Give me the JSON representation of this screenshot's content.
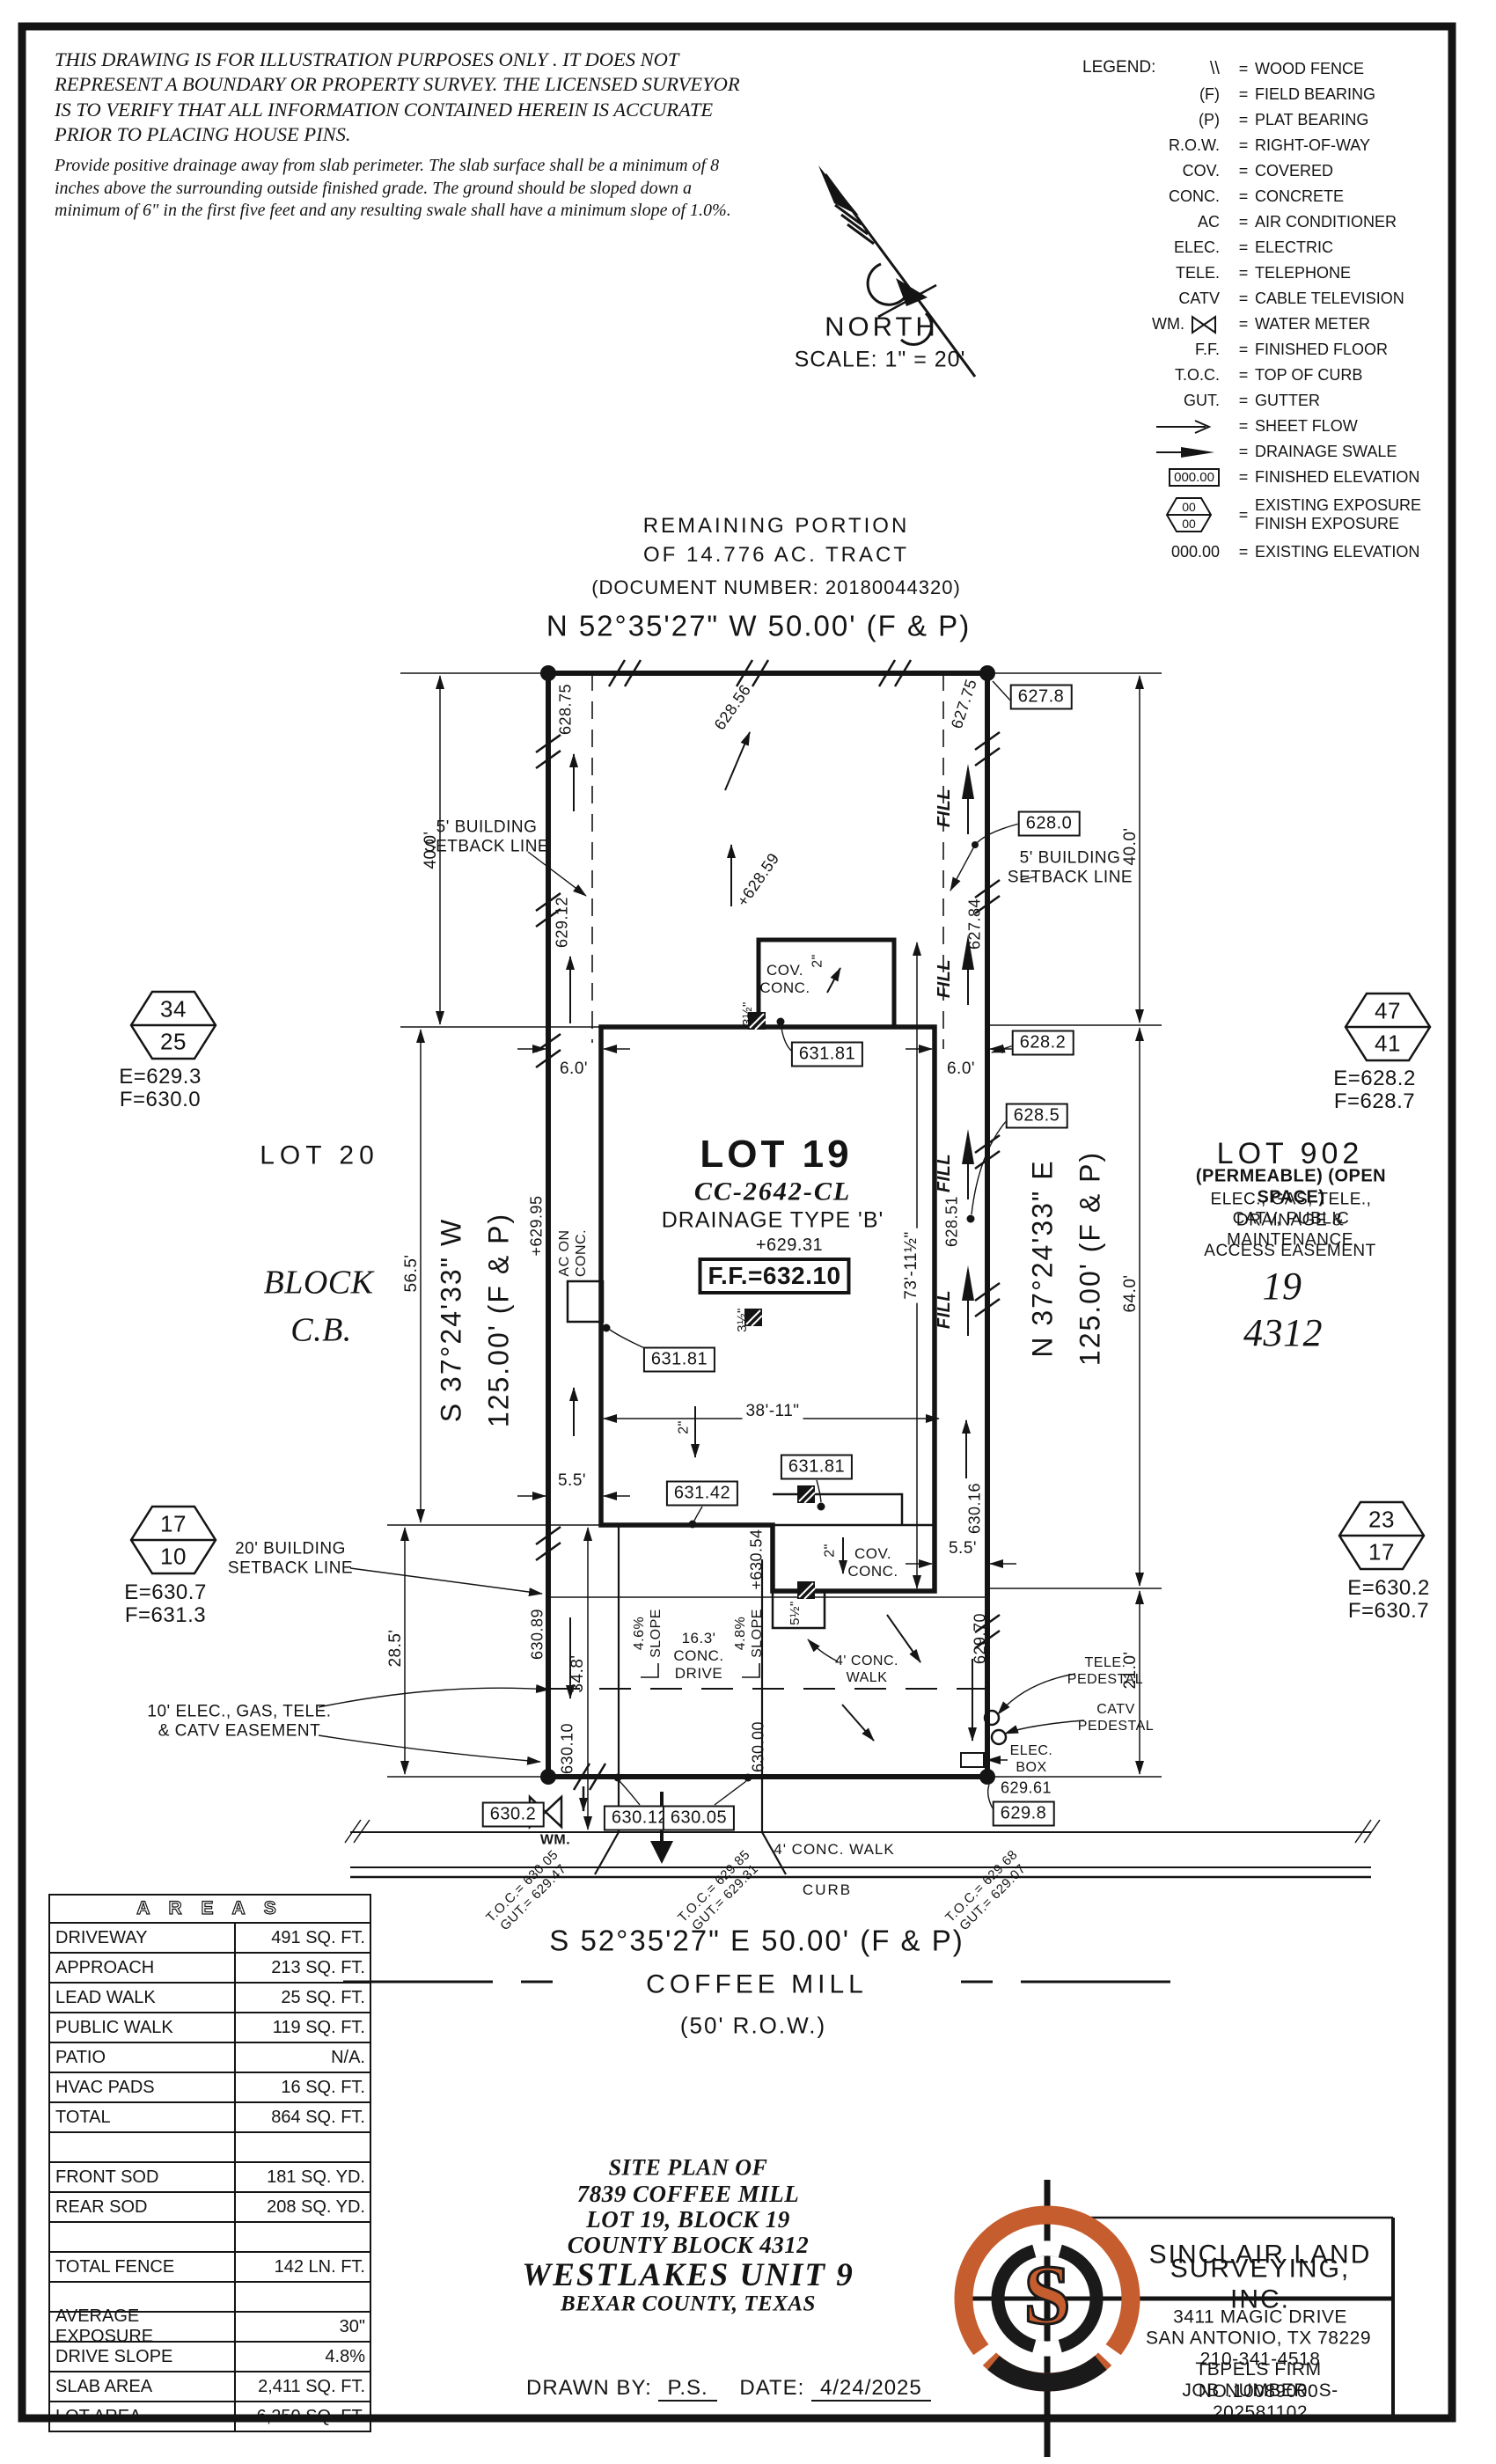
{
  "disclaimer": {
    "para1": "THIS DRAWING IS FOR ILLUSTRATION PURPOSES ONLY . IT DOES\nNOT REPRESENT A BOUNDARY OR PROPERTY SURVEY. THE\nLICENSED SURVEYOR IS TO VERIFY THAT ALL INFORMATION\nCONTAINED HEREIN IS ACCURATE PRIOR TO PLACING HOUSE PINS.",
    "para2": "Provide positive drainage away from slab perimeter. The slab surface shall be a\nminimum of 8 inches above the surrounding outside finished grade. The ground should be\nsloped down a minimum of 6\" in the first five feet and any resulting swale shall have a\nminimum slope of 1.0%."
  },
  "north": {
    "label": "NORTH",
    "scale": "SCALE: 1\" = 20'"
  },
  "legend": {
    "title": "LEGEND:",
    "eq": "=",
    "hex00": "00",
    "rows": [
      {
        "sym": "\\\\",
        "desc": "WOOD FENCE"
      },
      {
        "sym": "(F)",
        "desc": "FIELD BEARING"
      },
      {
        "sym": "(P)",
        "desc": "PLAT BEARING"
      },
      {
        "sym": "R.O.W.",
        "desc": "RIGHT-OF-WAY"
      },
      {
        "sym": "COV.",
        "desc": "COVERED"
      },
      {
        "sym": "CONC.",
        "desc": "CONCRETE"
      },
      {
        "sym": "AC",
        "desc": "AIR CONDITIONER"
      },
      {
        "sym": "ELEC.",
        "desc": "ELECTRIC"
      },
      {
        "sym": "TELE.",
        "desc": "TELEPHONE"
      },
      {
        "sym": "CATV",
        "desc": "CABLE TELEVISION"
      },
      {
        "sym": "WM.",
        "desc": "WATER METER"
      },
      {
        "sym": "F.F.",
        "desc": "FINISHED FLOOR"
      },
      {
        "sym": "T.O.C.",
        "desc": "TOP OF CURB"
      },
      {
        "sym": "GUT.",
        "desc": "GUTTER"
      },
      {
        "sym": "",
        "desc": "SHEET FLOW"
      },
      {
        "sym": "",
        "desc": "DRAINAGE SWALE"
      },
      {
        "sym": "000.00",
        "desc": "FINISHED ELEVATION"
      },
      {
        "sym": "",
        "desc": "EXISTING EXPOSURE\nFINISH EXPOSURE"
      },
      {
        "sym": "000.00",
        "desc": "EXISTING ELEVATION"
      }
    ]
  },
  "tract": {
    "line1": "REMAINING PORTION",
    "line2": "OF 14.776 AC. TRACT",
    "doc": "(DOCUMENT NUMBER: 20180044320)"
  },
  "bearings": {
    "top": "N 52°35'27\" W  50.00' (F & P)",
    "bottom": "S 52°35'27\" E  50.00' (F & P)",
    "left": "S 37°24'33\" W\n125.00' (F & P)",
    "right": "N 37°24'33\" E\n125.00' (F & P)"
  },
  "street": {
    "name": "COFFEE MILL",
    "row": "(50' R.O.W.)",
    "curb": "CURB",
    "walk": "4' CONC. WALK"
  },
  "lot": {
    "title": "LOT 19",
    "plan": "CC-2642-CL",
    "drainage": "DRAINAGE TYPE 'B'",
    "spot": "+629.31",
    "ff": "F.F.=632.10"
  },
  "neighbors": {
    "lot20": "LOT 20",
    "block": "BLOCK",
    "cb": "C.B.",
    "lot902": "LOT 902",
    "permeable": "(PERMEABLE) (OPEN SPACE)",
    "ease1": "ELEC., GAS, TELE., CATV, PUBLIC",
    "ease2": "DRAINAGE & MAINTENANCE",
    "ease3": "ACCESS EASEMENT",
    "blk19": "19",
    "cb4312": "4312"
  },
  "hex": {
    "h1t": "34",
    "h1b": "25",
    "h1e": "E=629.3",
    "h1f": "F=630.0",
    "h2t": "47",
    "h2b": "41",
    "h2e": "E=628.2",
    "h2f": "F=628.7",
    "h3t": "17",
    "h3b": "10",
    "h3e": "E=630.7",
    "h3f": "F=631.3",
    "h4t": "23",
    "h4b": "17",
    "h4e": "E=630.2",
    "h4f": "F=630.7"
  },
  "callouts": {
    "setback5": "5' BUILDING\nSETBACK LINE",
    "setback20": "20' BUILDING\nSETBACK LINE",
    "easement10": "10' ELEC., GAS, TELE.\n& CATV EASEMENT",
    "covconc": "COV.\nCONC.",
    "ac": "AC ON\nCONC.",
    "drive": "16.3'\nCONC.\nDRIVE",
    "slope46": "4.6%\nSLOPE",
    "slope48": "4.8%\nSLOPE",
    "leadwalk": "4' CONC.\nWALK",
    "tele": "TELE.\nPEDESTAL",
    "catv": "CATV\nPEDESTAL",
    "elecbox": "ELEC.\nBOX",
    "wm": "WM.",
    "fill": "FILL"
  },
  "dims": {
    "d40": "40.0'",
    "d565": "56.5'",
    "d64": "64.0'",
    "d285": "28.5'",
    "d348": "34.8'",
    "d21": "21.0'",
    "d3811": "38'-11\"",
    "d7311": "73'-11½\"",
    "d6": "6.0'",
    "d55": "5.5'",
    "d2": "2\"",
    "d312": "3½\"",
    "d512": "5½\""
  },
  "elev": {
    "boxed": {
      "v6278": "627.8",
      "v6280": "628.0",
      "v6282": "628.2",
      "v6285": "628.5",
      "v63181": "631.81",
      "v63142": "631.42",
      "v6302": "630.2",
      "v63012": "630.12",
      "v63005": "630.05",
      "v6298": "629.8"
    },
    "spot": {
      "v62875": "628.75",
      "v62912": "629.12",
      "v62856": "628.56",
      "v62775": "627.75",
      "v62784": "627.84",
      "v62851": "628.51",
      "v62859": "+628.59",
      "v62995": "+629.95",
      "v63054": "+630.54",
      "v63016": "630.16",
      "v62970": "629.70",
      "v63089": "630.89",
      "v63010": "630.10",
      "v63000": "630.00",
      "v62961": "629.61"
    }
  },
  "toc": {
    "t1": "T.O.C.= 630.05\nGUT.= 629.47",
    "t2": "T.O.C.= 629.85\nGUT.= 629.31",
    "t3": "T.O.C.= 629.68\nGUT.= 629.07"
  },
  "areas": {
    "title": "A R E A S",
    "rows": [
      {
        "label": "DRIVEWAY",
        "value": "491 SQ. FT."
      },
      {
        "label": "APPROACH",
        "value": "213 SQ. FT."
      },
      {
        "label": "LEAD WALK",
        "value": "25 SQ. FT."
      },
      {
        "label": "PUBLIC WALK",
        "value": "119 SQ. FT."
      },
      {
        "label": "PATIO",
        "value": "N/A."
      },
      {
        "label": "HVAC PADS",
        "value": "16 SQ. FT."
      },
      {
        "label": "TOTAL",
        "value": "864 SQ. FT."
      },
      {
        "label": "",
        "value": ""
      },
      {
        "label": "FRONT SOD",
        "value": "181 SQ. YD."
      },
      {
        "label": "REAR SOD",
        "value": "208 SQ. YD."
      },
      {
        "label": "",
        "value": ""
      },
      {
        "label": "TOTAL FENCE",
        "value": "142 LN. FT."
      },
      {
        "label": "",
        "value": ""
      },
      {
        "label": "AVERAGE EXPOSURE",
        "value": "30\""
      },
      {
        "label": "DRIVE SLOPE",
        "value": "4.8%"
      },
      {
        "label": "SLAB AREA",
        "value": "2,411 SQ. FT."
      },
      {
        "label": "LOT AREA",
        "value": "6,250 SQ. FT."
      }
    ]
  },
  "titleblock": {
    "l1": "SITE PLAN OF",
    "l2": "7839 COFFEE MILL",
    "l3": "LOT 19, BLOCK 19",
    "l4": "COUNTY BLOCK 4312",
    "l5": "WESTLAKES UNIT 9",
    "l6": "BEXAR COUNTY, TEXAS",
    "drawn_label": "DRAWN BY:",
    "drawn": "P.S.",
    "date_label": "DATE:",
    "date": "4/24/2025"
  },
  "company": {
    "name1": "SINCLAIR LAND",
    "name2": "SURVEYING, INC.",
    "addr1": "3411 MAGIC DRIVE",
    "addr2": "SAN ANTONIO, TX 78229",
    "phone": "210-341-4518",
    "firm": "TBPELS FIRM NO.10089000",
    "job": "JOB NUMBER: S-202581102",
    "logo_letter": "S"
  }
}
